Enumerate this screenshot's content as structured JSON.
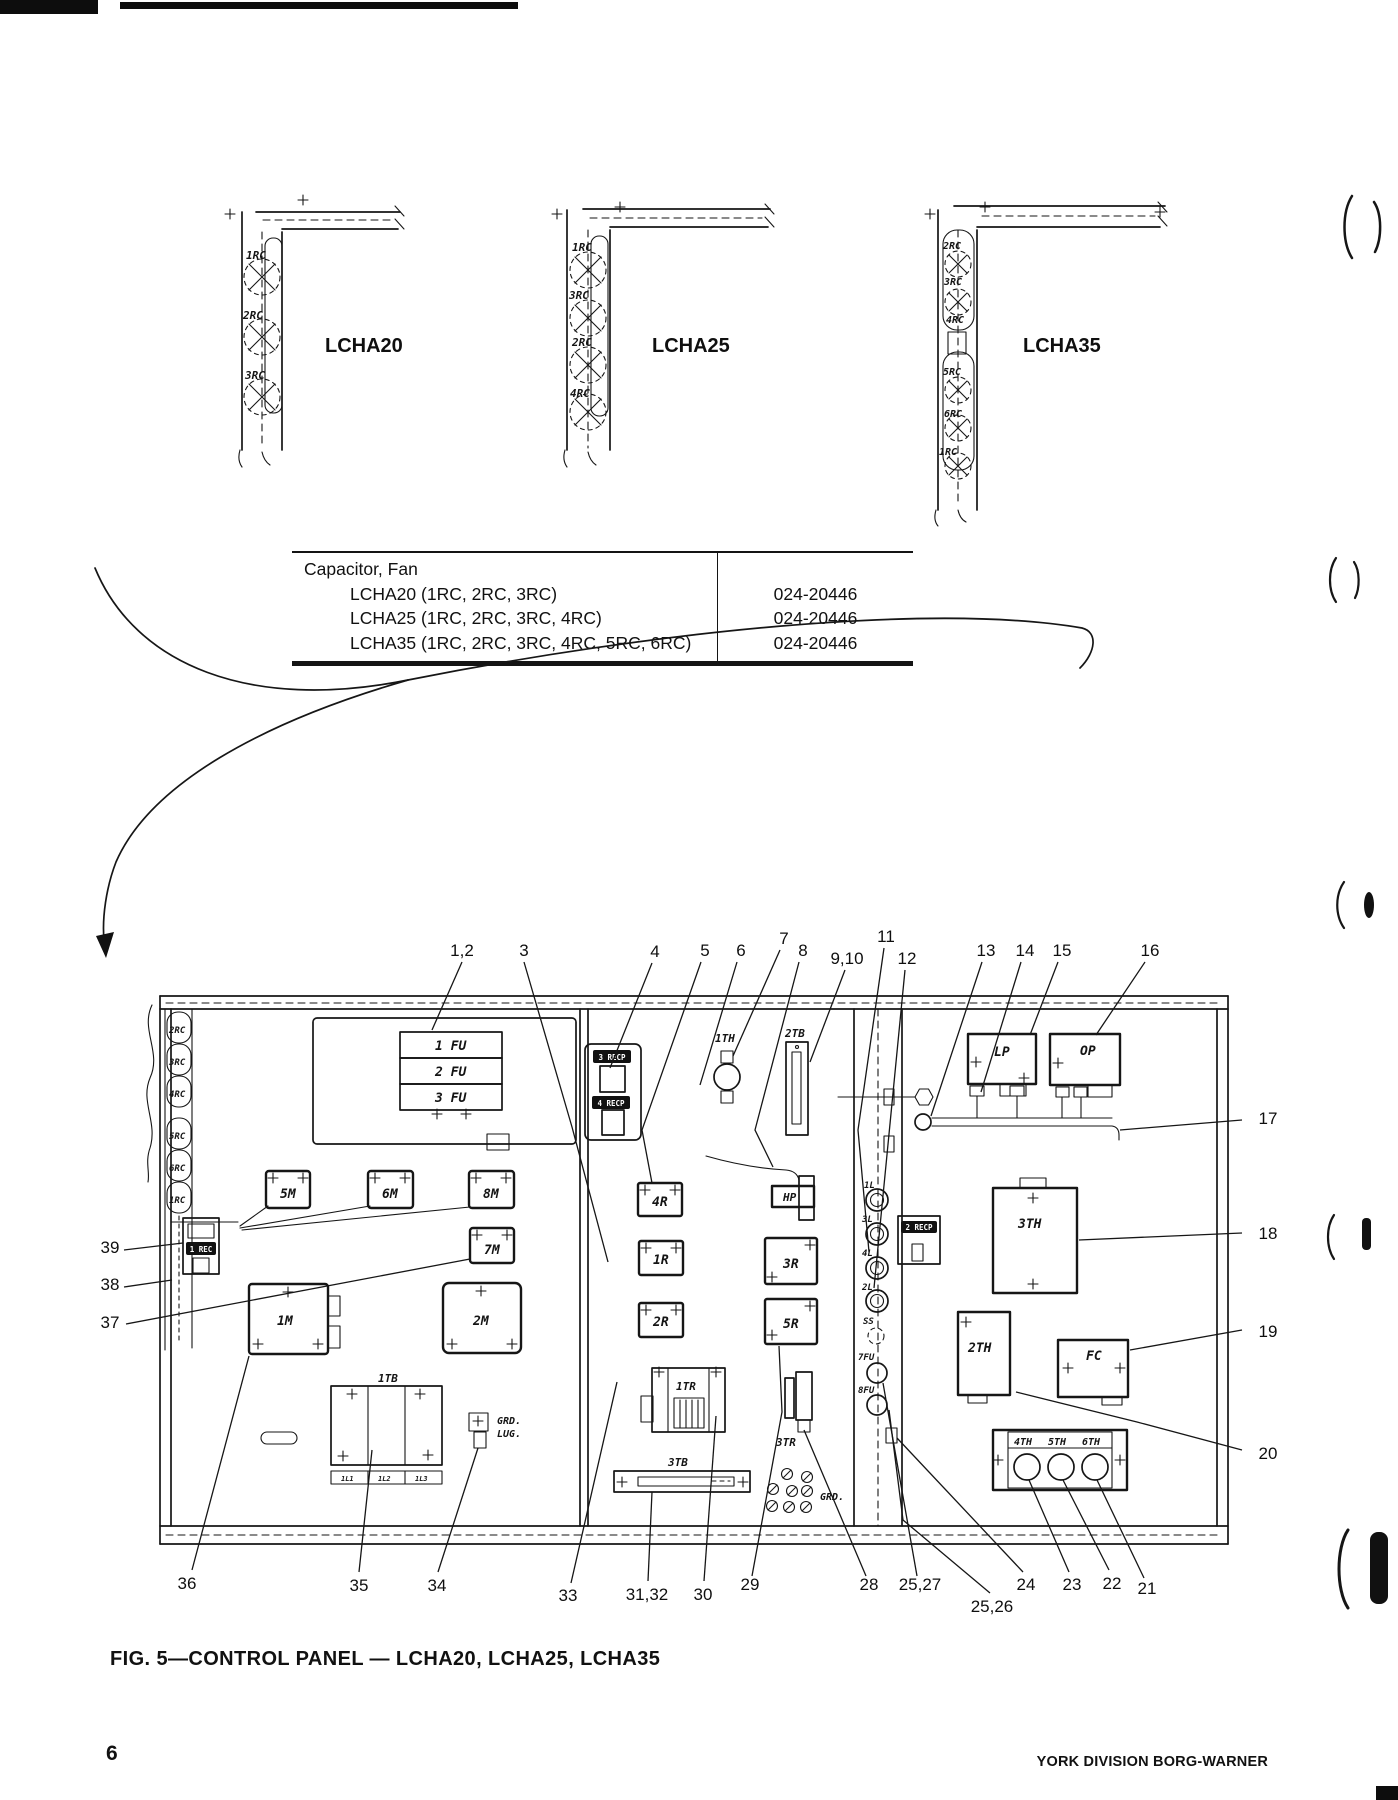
{
  "page": {
    "caption": "FIG. 5—CONTROL PANEL — LCHA20, LCHA25, LCHA35",
    "page_number": "6",
    "footer": "YORK DIVISION BORG-WARNER"
  },
  "duct_diagrams": [
    {
      "model": "LCHA20",
      "fan_labels": [
        "1RC",
        "2RC",
        "3RC"
      ]
    },
    {
      "model": "LCHA25",
      "fan_labels": [
        "1RC",
        "3RC",
        "2RC",
        "4RC"
      ]
    },
    {
      "model": "LCHA35",
      "fan_labels": [
        "2RC",
        "3RC",
        "4RC",
        "5RC",
        "6RC",
        "1RC"
      ]
    }
  ],
  "parts_table": {
    "group_label": "Capacitor, Fan",
    "rows": [
      {
        "item": "LCHA20 (1RC, 2RC, 3RC)",
        "part": "024-20446"
      },
      {
        "item": "LCHA25 (1RC, 2RC, 3RC, 4RC)",
        "part": "024-20446"
      },
      {
        "item": "LCHA35 (1RC, 2RC, 3RC, 4RC, 5RC, 6RC)",
        "part": "024-20446"
      }
    ]
  },
  "panel": {
    "capacitors": [
      "2RC",
      "3RC",
      "4RC",
      "5RC",
      "6RC",
      "1RC"
    ],
    "fuses": [
      "1 FU",
      "2 FU",
      "3 FU"
    ],
    "rec1": "1 REC",
    "contactor_5m": "5M",
    "contactor_6m": "6M",
    "contactor_8m": "8M",
    "contactor_7m": "7M",
    "contactor_1m": "1M",
    "contactor_2m": "2M",
    "tb1_label": "1TB",
    "tb1_terminals": [
      "1L1",
      "1L2",
      "1L3"
    ],
    "grd_lug_line1": "GRD.",
    "grd_lug_line2": "LUG.",
    "recp3": "3 RECP",
    "recp4": "4 RECP",
    "recp2": "2 RECP",
    "th1": "1TH",
    "tb2": "2TB",
    "hp": "HP",
    "relay_4r": "4R",
    "relay_1r": "1R",
    "relay_2r": "2R",
    "relay_3r": "3R",
    "relay_5r": "5R",
    "tr1": "1TR",
    "tb3": "3TB",
    "tr3": "3TR",
    "grd": "GRD.",
    "lp": "LP",
    "op": "OP",
    "term_1l": "1L",
    "term_3l": "3L",
    "term_4l": "4L",
    "term_2l": "2L",
    "ss": "SS",
    "fu7": "7FU",
    "fu8": "8FU",
    "th3": "3TH",
    "th2": "2TH",
    "fc": "FC",
    "th4": "4TH",
    "th5": "5TH",
    "th6": "6TH",
    "callouts_top": [
      "1,2",
      "3",
      "4",
      "5",
      "6",
      "7",
      "8",
      "9,10",
      "11",
      "12",
      "13",
      "14",
      "15",
      "16"
    ],
    "callouts_left": [
      "39",
      "38",
      "37"
    ],
    "callouts_right": [
      "17",
      "18",
      "19",
      "20"
    ],
    "callouts_bottom": [
      "36",
      "35",
      "34",
      "33",
      "31,32",
      "30",
      "29",
      "28",
      "25,27",
      "25,26",
      "24",
      "23",
      "22",
      "21"
    ]
  }
}
